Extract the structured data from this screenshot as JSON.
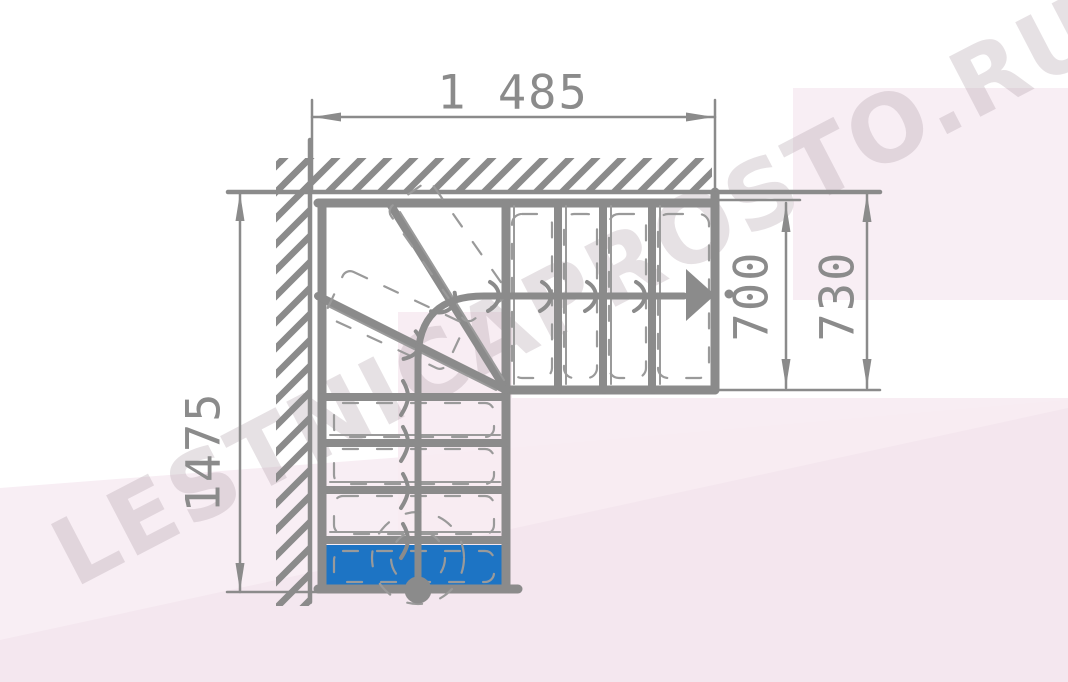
{
  "drawing": {
    "dimensions": {
      "top_width_mm": "1 485",
      "left_depth_mm": "1475",
      "flight_inner_width_mm": "700",
      "flight_outer_width_mm": "730"
    },
    "watermark": "LESTNICAPROSTO.RU",
    "colors": {
      "line": "#8b8b8b",
      "thin_line": "#9a9a9a",
      "first_step_fill": "#1d74c4",
      "tint_pink": "#f7ebf2",
      "tint_pink_dark": "#f3e5ed",
      "tint_pink_light": "#f8eef4",
      "watermark_text": "rgba(172,154,165,0.30)"
    }
  }
}
